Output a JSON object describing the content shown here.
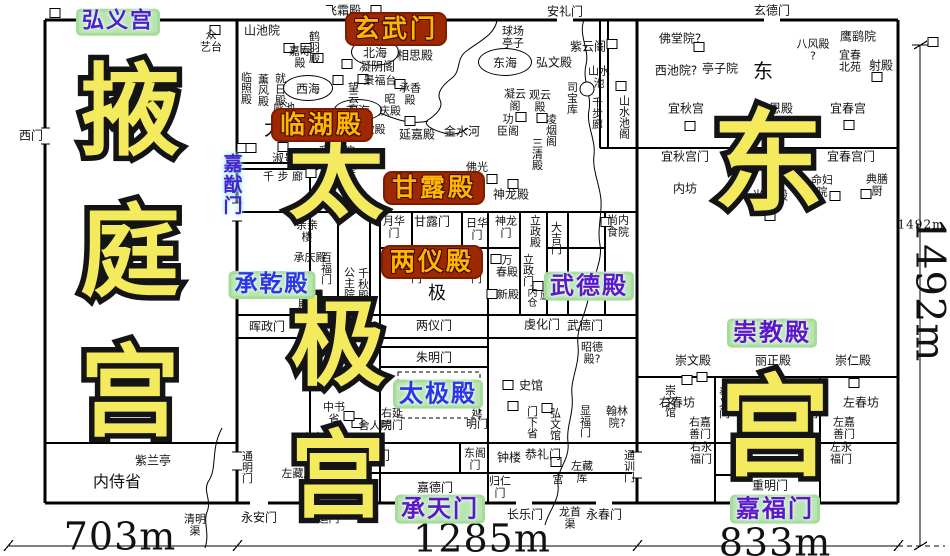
{
  "big_titles": [
    {
      "t": "掖",
      "x": 130,
      "y": 112,
      "s": 100
    },
    {
      "t": "庭",
      "x": 130,
      "y": 253,
      "s": 100
    },
    {
      "t": "宫",
      "x": 130,
      "y": 393,
      "s": 100
    },
    {
      "t": "太",
      "x": 336,
      "y": 178,
      "s": 95
    },
    {
      "t": "极",
      "x": 338,
      "y": 345,
      "s": 95
    },
    {
      "t": "宫",
      "x": 338,
      "y": 477,
      "s": 95
    },
    {
      "t": "东",
      "x": 768,
      "y": 163,
      "s": 110
    },
    {
      "t": "宫",
      "x": 775,
      "y": 428,
      "s": 110
    }
  ],
  "labels": [
    {
      "t": "飞霜殿",
      "x": 343,
      "y": 11
    },
    {
      "t": "安礼门",
      "x": 565,
      "y": 12
    },
    {
      "t": "玄德门",
      "x": 772,
      "y": 11
    },
    {
      "t": "弘义宫",
      "x": 118,
      "y": 22,
      "cls": "g",
      "c": "#4a22cc",
      "fs": 22
    },
    {
      "t": "玄武门",
      "x": 396,
      "y": 29,
      "cls": "r",
      "fs": 25
    },
    {
      "t": "西门",
      "x": 31,
      "y": 136
    },
    {
      "t": "众\n艺台",
      "x": 211,
      "y": 42,
      "fs": 11
    },
    {
      "t": "山池院",
      "x": 262,
      "y": 31
    },
    {
      "t": "嘉寿\n殿",
      "x": 300,
      "y": 58,
      "fs": 11
    },
    {
      "t": "鹤羽殿",
      "x": 314,
      "y": 47,
      "v": 1,
      "fs": 11
    },
    {
      "t": "临照殿",
      "x": 246,
      "y": 88,
      "v": 1,
      "fs": 11
    },
    {
      "t": "薰风殿",
      "x": 263,
      "y": 90,
      "v": 1,
      "fs": 11
    },
    {
      "t": "就日殿",
      "x": 280,
      "y": 89,
      "v": 1,
      "fs": 11
    },
    {
      "t": "太",
      "x": 274,
      "y": 128,
      "fs": 20
    },
    {
      "t": "凝阴阁",
      "x": 377,
      "y": 67
    },
    {
      "t": "相思殿",
      "x": 415,
      "y": 56
    },
    {
      "t": "景福台",
      "x": 380,
      "y": 81,
      "fs": 11
    },
    {
      "t": "望云亭",
      "x": 353,
      "y": 98,
      "v": 1,
      "fs": 11
    },
    {
      "t": "承香\n殿",
      "x": 410,
      "y": 95,
      "fs": 11
    },
    {
      "t": "昭\n庆殿",
      "x": 390,
      "y": 106,
      "fs": 11
    },
    {
      "t": "咸池",
      "x": 284,
      "y": 108,
      "fs": 11
    },
    {
      "t": "临湖殿",
      "x": 322,
      "y": 125,
      "cls": "r",
      "fs": 25
    },
    {
      "t": "紫微殿",
      "x": 369,
      "y": 130,
      "fs": 11
    },
    {
      "t": "延嘉殿",
      "x": 417,
      "y": 135
    },
    {
      "t": "金水河",
      "x": 462,
      "y": 132
    },
    {
      "t": "彩丝院",
      "x": 337,
      "y": 152
    },
    {
      "t": "归真院",
      "x": 338,
      "y": 173
    },
    {
      "t": "淑景殿",
      "x": 290,
      "y": 159
    },
    {
      "t": "千 步 廊",
      "x": 283,
      "y": 177,
      "fs": 11
    },
    {
      "t": "嘉猷门",
      "x": 231,
      "y": 185,
      "cls": "jia",
      "v": 1,
      "fs": 19
    },
    {
      "t": "球场\n亭子",
      "x": 513,
      "y": 38,
      "fs": 11
    },
    {
      "t": "弘文殿",
      "x": 554,
      "y": 63
    },
    {
      "t": "紫云阁",
      "x": 588,
      "y": 47
    },
    {
      "t": "凝云\n阁",
      "x": 515,
      "y": 101,
      "fs": 11
    },
    {
      "t": "观云\n殿",
      "x": 540,
      "y": 102,
      "fs": 11
    },
    {
      "t": "司宝库",
      "x": 572,
      "y": 98,
      "v": 1,
      "fs": 11
    },
    {
      "t": "山水\n池",
      "x": 599,
      "y": 78,
      "fs": 11
    },
    {
      "t": "千步廊",
      "x": 597,
      "y": 113,
      "v": 1,
      "fs": 11
    },
    {
      "t": "山水池阁",
      "x": 624,
      "y": 117,
      "v": 1,
      "fs": 11
    },
    {
      "t": "功\n臣阁",
      "x": 508,
      "y": 126,
      "fs": 11
    },
    {
      "t": "凌烟阁",
      "x": 551,
      "y": 130,
      "v": 1,
      "fs": 11
    },
    {
      "t": "三清殿",
      "x": 537,
      "y": 154,
      "v": 1,
      "fs": 11
    },
    {
      "t": "佛光\n寺",
      "x": 477,
      "y": 174,
      "fs": 11
    },
    {
      "t": "神龙殿",
      "x": 511,
      "y": 195
    },
    {
      "t": "甘露殿",
      "x": 434,
      "y": 188,
      "cls": "r",
      "fs": 25
    },
    {
      "t": "尚内\n食院",
      "x": 618,
      "y": 227,
      "fs": 11
    },
    {
      "t": "月华\n门",
      "x": 394,
      "y": 228,
      "fs": 11
    },
    {
      "t": "甘露门",
      "x": 432,
      "y": 222
    },
    {
      "t": "日华\n门",
      "x": 477,
      "y": 230,
      "fs": 11
    },
    {
      "t": "神龙\n门",
      "x": 506,
      "y": 228,
      "fs": 11
    },
    {
      "t": "立政殿",
      "x": 535,
      "y": 231,
      "v": 1,
      "fs": 11
    },
    {
      "t": "大吉门",
      "x": 556,
      "y": 238,
      "v": 1,
      "fs": 11
    },
    {
      "t": "两仪殿",
      "x": 432,
      "y": 262,
      "cls": "r",
      "fs": 25
    },
    {
      "t": "宜秋门",
      "x": 416,
      "y": 267,
      "v": 1,
      "fs": 11
    },
    {
      "t": "献春门",
      "x": 476,
      "y": 267,
      "v": 1,
      "fs": 11
    },
    {
      "t": "万\n春殿",
      "x": 507,
      "y": 267,
      "fs": 11
    },
    {
      "t": "新殿",
      "x": 508,
      "y": 295,
      "fs": 11
    },
    {
      "t": "立政门",
      "x": 528,
      "y": 270,
      "v": 1,
      "fs": 11
    },
    {
      "t": "内仓",
      "x": 530,
      "y": 297,
      "v": 1,
      "fs": 10
    },
    {
      "t": "廪",
      "x": 545,
      "y": 297,
      "fs": 10
    },
    {
      "t": "武德殿",
      "x": 589,
      "y": 286,
      "cls": "g",
      "c": "#5a18c8",
      "fs": 24
    },
    {
      "t": "亲亲\n楼",
      "x": 307,
      "y": 232,
      "fs": 11
    },
    {
      "t": "承庆殿",
      "x": 310,
      "y": 258,
      "fs": 11
    },
    {
      "t": "百福门",
      "x": 326,
      "y": 268,
      "v": 1,
      "fs": 11
    },
    {
      "t": "百福殿",
      "x": 303,
      "y": 293,
      "v": 1,
      "fs": 11
    },
    {
      "t": "公主院",
      "x": 349,
      "y": 283,
      "v": 1,
      "fs": 11
    },
    {
      "t": "千秋殿",
      "x": 363,
      "y": 284,
      "v": 1,
      "fs": 11
    },
    {
      "t": "承乾殿",
      "x": 272,
      "y": 285,
      "cls": "g",
      "c": "#2a35e8",
      "fs": 23
    },
    {
      "t": "极",
      "x": 437,
      "y": 294,
      "fs": 18
    },
    {
      "t": "晖政门",
      "x": 267,
      "y": 327
    },
    {
      "t": "两仪门",
      "x": 434,
      "y": 326
    },
    {
      "t": "虔化门",
      "x": 542,
      "y": 325
    },
    {
      "t": "武德门",
      "x": 585,
      "y": 326
    },
    {
      "t": "昭德\n殿?",
      "x": 592,
      "y": 354,
      "fs": 11
    },
    {
      "t": "朱明门",
      "x": 434,
      "y": 358
    },
    {
      "t": "太极殿",
      "x": 438,
      "y": 394,
      "cls": "g",
      "c": "#2a35e8",
      "fs": 24
    },
    {
      "t": "史馆",
      "x": 531,
      "y": 386
    },
    {
      "t": "中书\n省",
      "x": 334,
      "y": 414,
      "fs": 11
    },
    {
      "t": "舍人院",
      "x": 375,
      "y": 426,
      "fs": 11
    },
    {
      "t": "内客省",
      "x": 318,
      "y": 438,
      "fs": 11
    },
    {
      "t": "右延\n明门",
      "x": 392,
      "y": 420,
      "fs": 11
    },
    {
      "t": "延\n明门",
      "x": 477,
      "y": 419,
      "fs": 11
    },
    {
      "t": "门下省",
      "x": 532,
      "y": 422,
      "v": 1,
      "fs": 11
    },
    {
      "t": "弘文馆",
      "x": 555,
      "y": 424,
      "v": 1,
      "fs": 11
    },
    {
      "t": "显福门",
      "x": 585,
      "y": 421,
      "v": 1,
      "fs": 11
    },
    {
      "t": "翰林\n院?",
      "x": 617,
      "y": 418,
      "fs": 11
    },
    {
      "t": "西阁\n门",
      "x": 320,
      "y": 459,
      "fs": 11
    },
    {
      "t": "太极门",
      "x": 372,
      "y": 456
    },
    {
      "t": "东阁\n门",
      "x": 475,
      "y": 460,
      "fs": 11
    },
    {
      "t": "钟楼",
      "x": 509,
      "y": 458
    },
    {
      "t": "恭礼门",
      "x": 543,
      "y": 455
    },
    {
      "t": "归仁\n门",
      "x": 500,
      "y": 488,
      "fs": 11
    },
    {
      "t": "左藏\n库",
      "x": 582,
      "y": 473,
      "fs": 11
    },
    {
      "t": "宫",
      "x": 558,
      "y": 480,
      "fs": 11
    },
    {
      "t": "嘉德门",
      "x": 435,
      "y": 488
    },
    {
      "t": "承天门",
      "x": 440,
      "y": 509,
      "cls": "g",
      "c": "#5a18c8",
      "fs": 24
    },
    {
      "t": "长乐门",
      "x": 525,
      "y": 515
    },
    {
      "t": "龙首\n渠",
      "x": 570,
      "y": 519,
      "fs": 11
    },
    {
      "t": "永春门",
      "x": 604,
      "y": 515
    },
    {
      "t": "通训门",
      "x": 629,
      "y": 466,
      "v": 1,
      "fs": 11
    },
    {
      "t": "左藏库",
      "x": 298,
      "y": 474,
      "fs": 11
    },
    {
      "t": "广运门",
      "x": 323,
      "y": 519,
      "fs": 11
    },
    {
      "t": "通明门",
      "x": 247,
      "y": 467,
      "v": 1,
      "fs": 11
    },
    {
      "t": "永安门",
      "x": 259,
      "y": 518
    },
    {
      "t": "清明\n渠",
      "x": 195,
      "y": 526,
      "fs": 11
    },
    {
      "t": "紫兰亭",
      "x": 153,
      "y": 461
    },
    {
      "t": "内侍省",
      "x": 117,
      "y": 482,
      "fs": 16
    },
    {
      "t": "佛堂院?",
      "x": 680,
      "y": 39
    },
    {
      "t": "西池院?",
      "x": 676,
      "y": 71
    },
    {
      "t": "亭子院",
      "x": 720,
      "y": 69
    },
    {
      "t": "东",
      "x": 763,
      "y": 71,
      "fs": 20
    },
    {
      "t": "八风殿\n?",
      "x": 813,
      "y": 51,
      "fs": 11
    },
    {
      "t": "鹰鹞院",
      "x": 858,
      "y": 37
    },
    {
      "t": "宜春\n北苑",
      "x": 850,
      "y": 62,
      "fs": 11
    },
    {
      "t": "射殿",
      "x": 881,
      "y": 66
    },
    {
      "t": "宜秋宫",
      "x": 686,
      "y": 109
    },
    {
      "t": "承恩殿",
      "x": 775,
      "y": 109
    },
    {
      "t": "宜春宫",
      "x": 848,
      "y": 109
    },
    {
      "t": "光天殿",
      "x": 770,
      "y": 196
    },
    {
      "t": "宜秋宫门",
      "x": 685,
      "y": 157
    },
    {
      "t": "宜春宫门",
      "x": 851,
      "y": 157
    },
    {
      "t": "内坊",
      "x": 685,
      "y": 189
    },
    {
      "t": "命妇\n院",
      "x": 822,
      "y": 187,
      "fs": 11
    },
    {
      "t": "典膳\n厨",
      "x": 877,
      "y": 186,
      "fs": 11
    },
    {
      "t": "崇教殿",
      "x": 772,
      "y": 333,
      "cls": "g",
      "c": "#5a18c8",
      "fs": 24
    },
    {
      "t": "崇文殿",
      "x": 693,
      "y": 361
    },
    {
      "t": "丽正殿",
      "x": 773,
      "y": 361
    },
    {
      "t": "崇仁殿",
      "x": 853,
      "y": 361
    },
    {
      "t": "崇文馆",
      "x": 670,
      "y": 401,
      "v": 1,
      "fs": 11
    },
    {
      "t": "右春坊",
      "x": 677,
      "y": 403
    },
    {
      "t": "左春坊",
      "x": 861,
      "y": 403
    },
    {
      "t": "奉义门",
      "x": 724,
      "y": 402,
      "v": 1,
      "fs": 11
    },
    {
      "t": "奉化门",
      "x": 812,
      "y": 402,
      "v": 1,
      "fs": 11
    },
    {
      "t": "右嘉\n善门",
      "x": 700,
      "y": 429,
      "fs": 11
    },
    {
      "t": "左嘉\n善门",
      "x": 844,
      "y": 429,
      "fs": 11
    },
    {
      "t": "右永\n福门",
      "x": 701,
      "y": 454,
      "fs": 11
    },
    {
      "t": "左永\n福门",
      "x": 841,
      "y": 454,
      "fs": 11
    },
    {
      "t": "重明门",
      "x": 770,
      "y": 486
    },
    {
      "t": "嘉福门",
      "x": 775,
      "y": 509,
      "cls": "g",
      "c": "#5a18c8",
      "fs": 24
    },
    {
      "t": "703m",
      "x": 120,
      "y": 537,
      "cls": "dim",
      "fs": 38
    },
    {
      "t": "1285m",
      "x": 482,
      "y": 539,
      "cls": "dim",
      "fs": 38
    },
    {
      "t": "833m",
      "x": 775,
      "y": 543,
      "cls": "dim",
      "fs": 38
    },
    {
      "t": "1492m",
      "x": 921,
      "y": 225,
      "cls": "dim",
      "fs": 12
    },
    {
      "t": "1492m",
      "x": 929,
      "y": 290,
      "cls": "dim",
      "fs": 40,
      "rot": 90
    }
  ],
  "markers": [
    [
      55,
      13
    ],
    [
      376,
      10
    ],
    [
      215,
      30
    ],
    [
      289,
      48
    ],
    [
      306,
      48
    ],
    [
      318,
      58
    ],
    [
      347,
      64
    ],
    [
      389,
      55
    ],
    [
      363,
      79
    ],
    [
      338,
      80
    ],
    [
      400,
      84
    ],
    [
      351,
      121
    ],
    [
      410,
      121
    ],
    [
      612,
      44
    ],
    [
      621,
      86
    ],
    [
      521,
      117
    ],
    [
      542,
      118
    ],
    [
      492,
      179
    ],
    [
      513,
      184
    ],
    [
      283,
      147
    ],
    [
      242,
      148
    ],
    [
      251,
      148
    ],
    [
      335,
      162
    ],
    [
      311,
      173
    ],
    [
      606,
      222
    ],
    [
      496,
      259
    ],
    [
      492,
      294
    ],
    [
      538,
      286
    ],
    [
      508,
      385
    ],
    [
      513,
      406
    ],
    [
      547,
      408
    ],
    [
      357,
      423
    ],
    [
      349,
      416
    ],
    [
      556,
      462
    ],
    [
      699,
      47
    ],
    [
      690,
      126
    ],
    [
      772,
      125
    ],
    [
      849,
      125
    ],
    [
      877,
      77
    ],
    [
      835,
      196
    ],
    [
      866,
      194
    ],
    [
      770,
      216
    ],
    [
      687,
      380
    ],
    [
      702,
      377
    ],
    [
      772,
      383
    ],
    [
      854,
      383
    ],
    [
      933,
      42
    ]
  ],
  "lakes": [
    {
      "t": "北海",
      "x": 375,
      "y": 52,
      "w": 46,
      "h": 26
    },
    {
      "t": "西海",
      "x": 308,
      "y": 88,
      "w": 48,
      "h": 24
    },
    {
      "t": "南海",
      "x": 358,
      "y": 110,
      "w": 46,
      "h": 20
    },
    {
      "t": "东海",
      "x": 505,
      "y": 62,
      "w": 52,
      "h": 26
    },
    {
      "t": "",
      "x": 587,
      "y": 89,
      "w": 13,
      "h": 13
    }
  ],
  "colors": {
    "big_fill": "#f3ea5e",
    "red_label_bg": "#9e2800",
    "red_label_text": "#ffb400",
    "green_label_bg": "#b8e4ae"
  }
}
